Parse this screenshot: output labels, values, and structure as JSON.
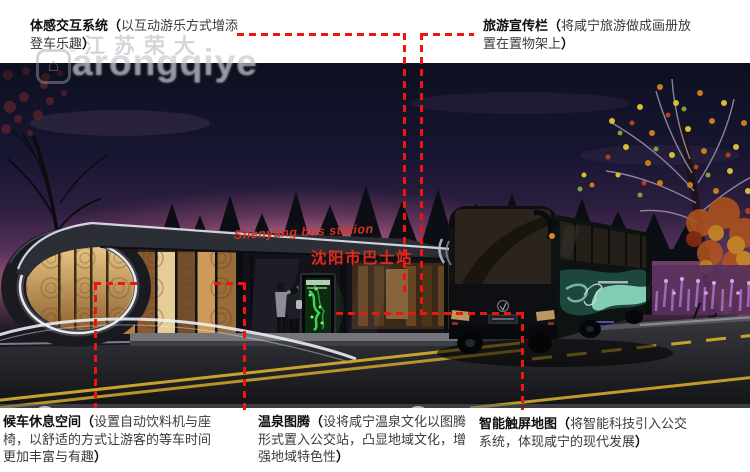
{
  "board": {
    "background": "#ffffff",
    "accent_red": "#ee1410"
  },
  "watermark": {
    "company": "江苏荣大",
    "brand": "arongqiye",
    "reg": "®",
    "logo_glyph": "⌂"
  },
  "banner": {
    "text": "江苏荣大 · 以品质成就价值",
    "logo_glyph": "⌂",
    "reg": "®"
  },
  "callouts": {
    "sensory_interaction": {
      "title": "体感交互系统",
      "open": "（",
      "body": "以互动游乐方式增添登车乐趣",
      "close": "）"
    },
    "tourism_board": {
      "title": "旅游宣传栏",
      "open": "（",
      "body": "将咸宁旅游做成画册放置在置物架上",
      "close": "）"
    },
    "waiting_lounge": {
      "title": "候车休息空间",
      "open": "（",
      "body": "设置自动饮料机与座椅，以舒适的方式让游客的等车时间更加丰富与有趣",
      "close": "）"
    },
    "hotspring_totem": {
      "title": "温泉图腾",
      "open": "（",
      "body": "设将咸宁温泉文化以图腾形式置入公交站，凸显地域文化，增强地域特色性",
      "close": "）"
    },
    "smart_map": {
      "title": "智能触屏地图",
      "open": "（",
      "body": "将智能科技引入公交系统，体现咸宁的现代发展",
      "close": "）"
    }
  },
  "scene": {
    "station_sign_en": "Shenyang bus station",
    "station_sign_cn": "沈阳市巴士站"
  }
}
